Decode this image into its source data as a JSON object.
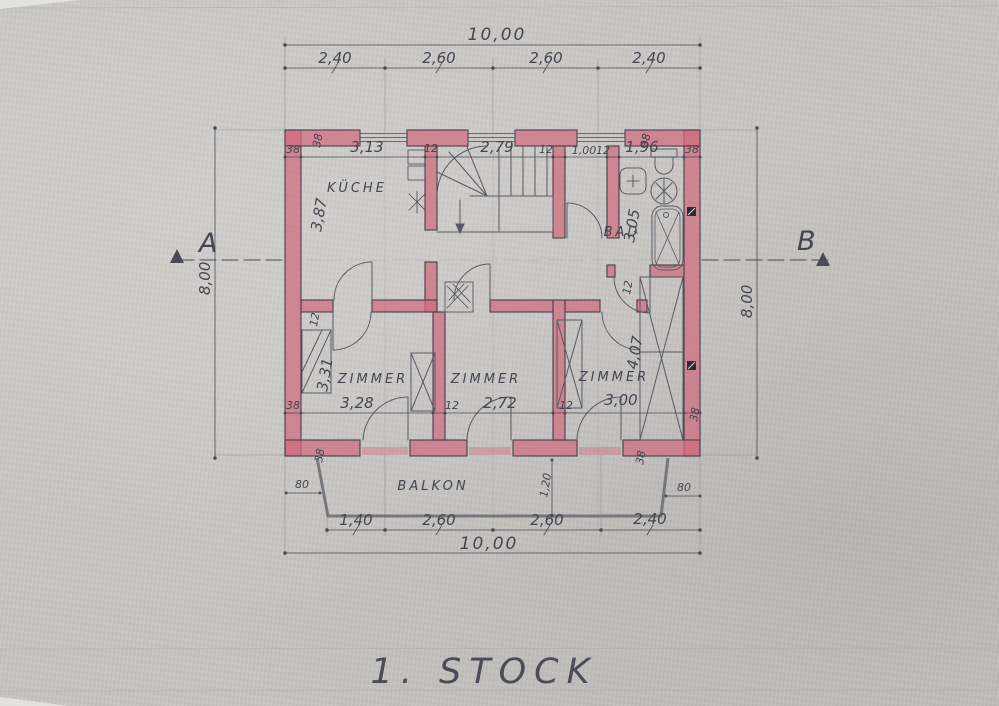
{
  "title": "1. STOCK",
  "colors": {
    "paper": "#c8c6c3",
    "pencil": "#4b4a55",
    "wall_fill": "#d06b7e"
  },
  "section": {
    "left_marker": "A",
    "right_marker": "B"
  },
  "rooms": {
    "kitchen": "KÜCHE",
    "bath": "BAD",
    "room_left": "ZIMMER",
    "room_middle": "ZIMMER",
    "room_right": "ZIMMER",
    "balcony": "BALKON"
  },
  "dims": {
    "overall_width_top": "10,00",
    "overall_width_bottom": "10,00",
    "height_left": "8,00",
    "height_right": "8,00",
    "top_segments": [
      "2,40",
      "2,60",
      "2,60",
      "2,40"
    ],
    "bottom_segments": [
      "1,40",
      "2,60",
      "2,60",
      "2,40"
    ],
    "top_interior": {
      "wall_left": "38",
      "kitchen": "3,13",
      "partition1": "12",
      "stairs": "2,79",
      "partition2": "12",
      "niche": "1,00",
      "partition3": "12",
      "bath": "1,96",
      "wall_right": "38"
    },
    "bottom_interior": {
      "wall_left": "38",
      "room_left": "3,28",
      "partition1": "12",
      "room_middle": "2,72",
      "partition2": "12",
      "room_right": "3,00",
      "wall_right": "38"
    },
    "kitchen_depth": "3,87",
    "room_left_depth": "3,31",
    "room_right_depth": "4,07",
    "bath_depth": "3,05",
    "balcony_depth": "1,20",
    "balcony_offset_left": "80",
    "balcony_offset_right": "80",
    "wall_thickness": {
      "top_left": "38",
      "top_right": "38",
      "bottom_left": "38",
      "bottom_right": "38"
    },
    "partition_thickness": {
      "kitchen_room": "12",
      "bath": "12"
    }
  }
}
